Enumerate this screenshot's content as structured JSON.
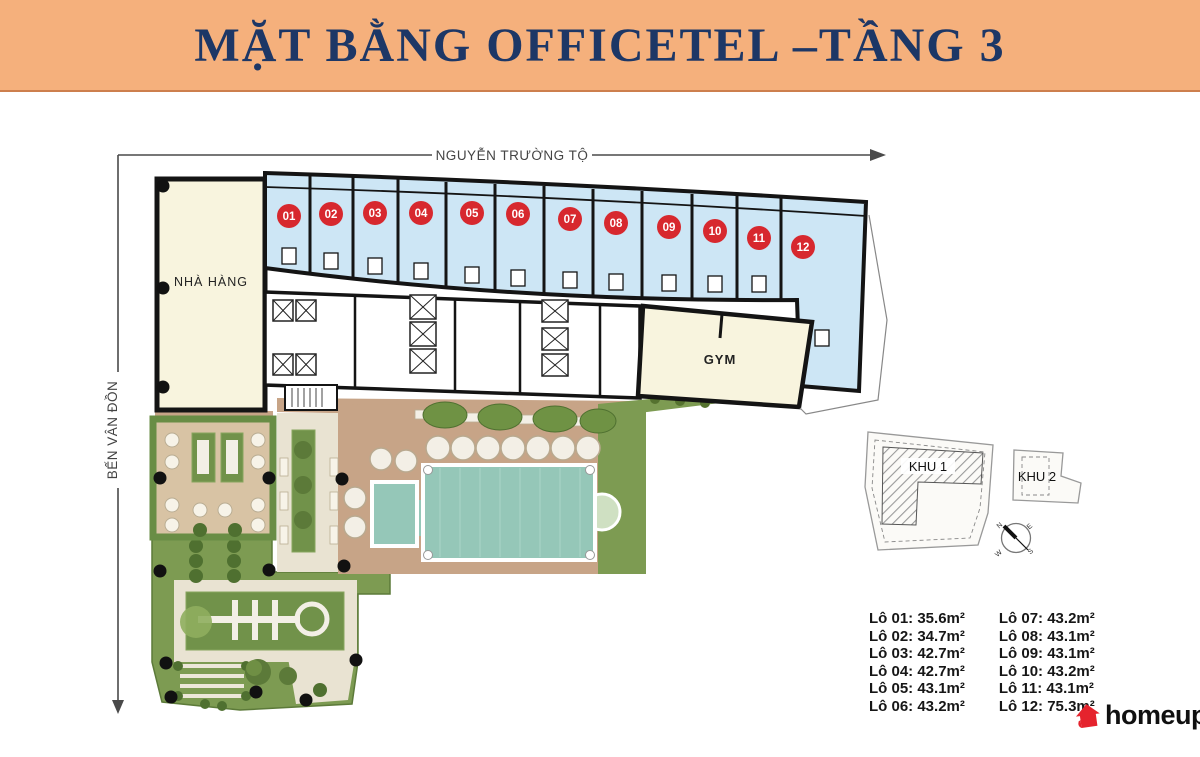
{
  "header": {
    "title": "MẶT BẰNG OFFICETEL –TẦNG 3"
  },
  "plan": {
    "streets": {
      "top": "NGUYỄN TRƯỜNG TỘ",
      "left": "BẾN VÂN ĐỒN"
    },
    "rooms": {
      "restaurant": "NHÀ HÀNG",
      "gym": "GYM"
    },
    "units": [
      "01",
      "02",
      "03",
      "04",
      "05",
      "06",
      "07",
      "08",
      "09",
      "10",
      "11",
      "12"
    ]
  },
  "keyplan": {
    "khu1": "KHU 1",
    "khu2": "KHU 2",
    "compass": {
      "n": "N",
      "e": "E",
      "s": "S",
      "w": "W"
    }
  },
  "legend": {
    "col1": [
      "Lô 01: 35.6m²",
      "Lô 02: 34.7m²",
      "Lô 03: 42.7m²",
      "Lô 04: 42.7m²",
      "Lô 05: 43.1m²",
      "Lô 06: 43.2m²"
    ],
    "col2": [
      "Lô 07: 43.2m²",
      "Lô 08: 43.1m²",
      "Lô 09: 43.1m²",
      "Lô 10: 43.2m²",
      "Lô 11: 43.1m²",
      "Lô 12: 75.3m²"
    ]
  },
  "logo": {
    "text": "homeup"
  },
  "colors": {
    "header_bg": "#f5b07c",
    "title": "#1d3766",
    "unit_fill": "#cde6f5",
    "wall": "#141414",
    "marker_red": "#d7282e",
    "room_cream": "#f8f4de",
    "lawn_green": "#7d9b52",
    "deck_tan": "#c7a487",
    "pool_teal": "#95c7b8",
    "logo_red": "#e5232d"
  }
}
